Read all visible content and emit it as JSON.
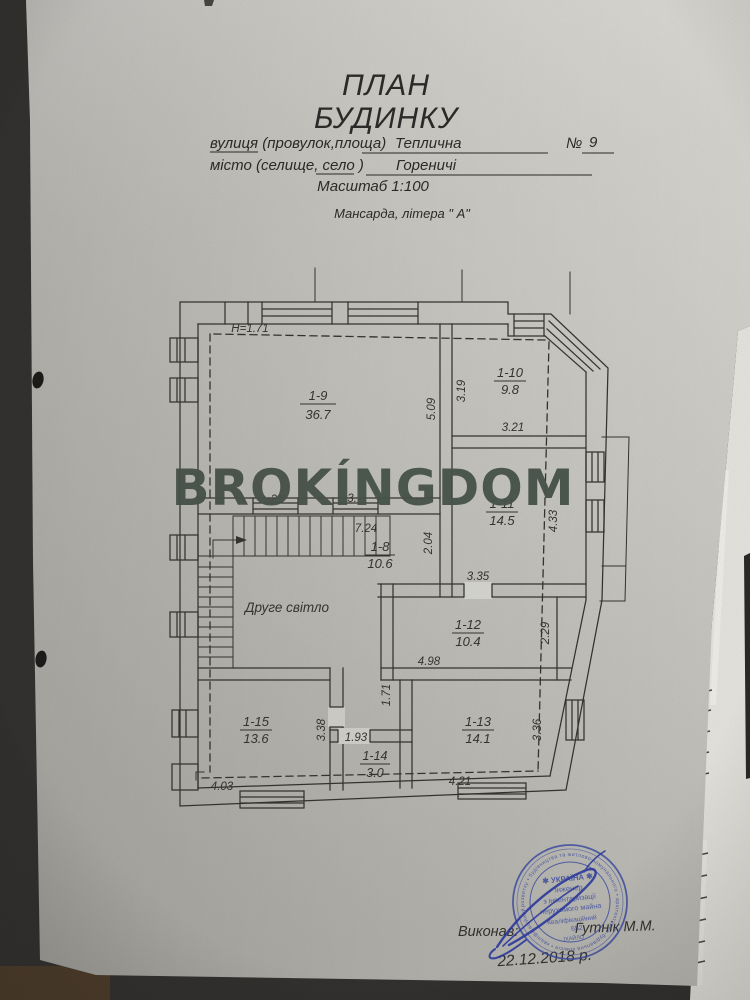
{
  "header": {
    "title_line1": "ПЛАН",
    "title_line2": "БУДИНКУ",
    "street_label": "вулиця (провулок,площа)",
    "street_value": "Теплична",
    "number_label": "№",
    "number_value": "9",
    "city_label": "місто (селище, село )",
    "city_value": "Гореничі",
    "scale": "Масштаб 1:100",
    "floor_note": "Мансарда, літера \" А\""
  },
  "watermark": {
    "text": "BROKÍNGDOM",
    "color": "#47524a"
  },
  "plan": {
    "height_note": "Н=1.71",
    "second_light": "Друге світло",
    "rooms": [
      {
        "id": "1-9",
        "area": "36.7"
      },
      {
        "id": "1-10",
        "area": "9.8"
      },
      {
        "id": "1-11",
        "area": "14.5"
      },
      {
        "id": "1-8",
        "area": "10.6"
      },
      {
        "id": "1-12",
        "area": "10.4"
      },
      {
        "id": "1-13",
        "area": "14.1"
      },
      {
        "id": "1-14",
        "area": "3.0"
      },
      {
        "id": "1-15",
        "area": "13.6"
      }
    ],
    "dims": {
      "d509": "5.09",
      "d319": "3.19",
      "d321": "3.21",
      "d433": "4.33",
      "d724": "7.24",
      "d204": "2.04",
      "d335": "3.35",
      "d229": "2.29",
      "d498": "4.98",
      "d171": "1.71",
      "d338": "3.38",
      "d193": "1.93",
      "d336": "3.36",
      "d403": "4.03",
      "d421": "4.21",
      "frag21": "21",
      "frag3": "3."
    }
  },
  "stamp": {
    "color": "#3a4aa1",
    "ring_text": "розвитку • будівництва та житлово-комунального • архітектурно-будівельна комісія • кваліфікаційний сертифікат •",
    "line_country": "✱ УКРАЇНА ✱",
    "line_role1": "Інженер",
    "line_role2": "з інвентаризації",
    "line_role3": "нерухомого майна",
    "line_cert": "Кваліфікаційний",
    "line_number": "652",
    "bottom_fragment": "ІХАЙЛО"
  },
  "footer": {
    "executor_label": "Виконав:",
    "executor_name": "Гутнік М.М.",
    "date": "22.12.2018 р."
  }
}
